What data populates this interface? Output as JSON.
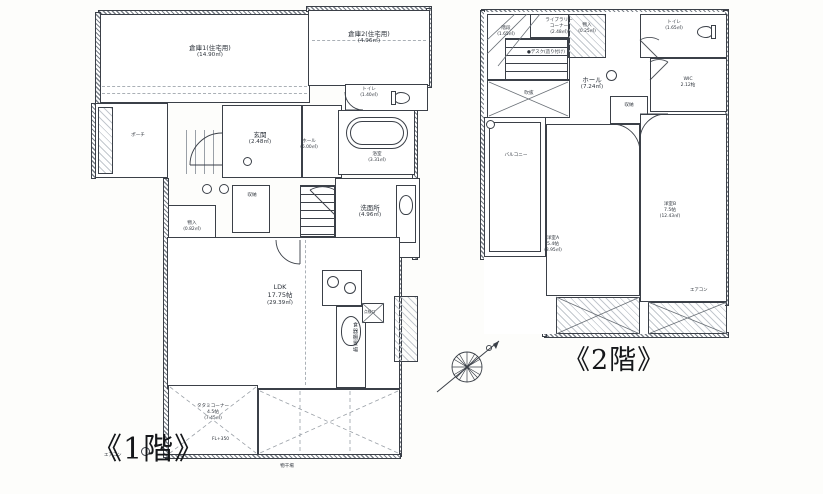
{
  "colors": {
    "line": "#3b4048",
    "paper": "#fdfdfb",
    "room_fill": "#ffffff"
  },
  "icons": {
    "toilet-icon": "bowl+tank shape",
    "bathtub-icon": "rounded rectangle",
    "stove-icon": "burner circles",
    "sink-icon": "oval basin",
    "stairs-icon": "parallel tread lines",
    "compass-icon": "circle with spokes and north arrow"
  },
  "floor1": {
    "label": "《1階》",
    "rooms": {
      "souko1": {
        "name": "倉庫1(住宅用)",
        "area": "(14.90㎡)"
      },
      "souko2": {
        "name": "倉庫2(住宅用)",
        "area": "(4.96㎡)"
      },
      "toilet": {
        "name": "トイレ",
        "area": "(1.40㎡)"
      },
      "porch": {
        "name": "ポーチ"
      },
      "genkan": {
        "name": "玄関",
        "area": "(2.48㎡)"
      },
      "hall": {
        "name": "ホール",
        "area": "(6.00㎡)"
      },
      "bath": {
        "name": "浴室",
        "area": "(3.31㎡)"
      },
      "senmen": {
        "name": "洗面所",
        "area": "(4.96㎡)"
      },
      "shuno": {
        "name": "収納"
      },
      "monoire": {
        "name": "物入",
        "area": "(0.82㎡)"
      },
      "ldk": {
        "name": "LDK",
        "size": "17.75帖",
        "area": "(29.39㎡)"
      },
      "tenkenko": {
        "name": "点検口"
      },
      "shokkidana": {
        "name": "食器棚置場"
      },
      "tatami": {
        "name": "タタミコーナー",
        "size": "4.5帖",
        "area": "(7.45㎡)"
      },
      "fl": {
        "name": "FL+350"
      },
      "monohoshi": {
        "name": "物干場"
      },
      "aircon": {
        "name": "エアコン"
      }
    }
  },
  "floor2": {
    "label": "《2階》",
    "rooms": {
      "kaidan": {
        "name": "階段",
        "area": "(1.65㎡)"
      },
      "library": {
        "name": "ライブラリー",
        "name2": "コーナー",
        "area": "(2.48㎡)",
        "note": "●デスク(造り付け)"
      },
      "monoire": {
        "name": "物入",
        "area": "(0.25㎡)"
      },
      "toilet": {
        "name": "トイレ",
        "area": "(1.65㎡)"
      },
      "hall": {
        "name": "ホール",
        "area": "(7.24㎡)"
      },
      "wic": {
        "name": "WIC",
        "size": "2.12帖"
      },
      "fukinuke": {
        "name": "吹抜"
      },
      "balcony": {
        "name": "バルコニー"
      },
      "shuno": {
        "name": "収納"
      },
      "yoshitsuA": {
        "name": "洋室A",
        "size": "5.4帖",
        "area": "(8.95㎡)"
      },
      "yoshitsuB": {
        "name": "洋室B",
        "size": "7.5帖",
        "area": "(12.43㎡)"
      },
      "aircon": {
        "name": "エアコン"
      }
    }
  }
}
